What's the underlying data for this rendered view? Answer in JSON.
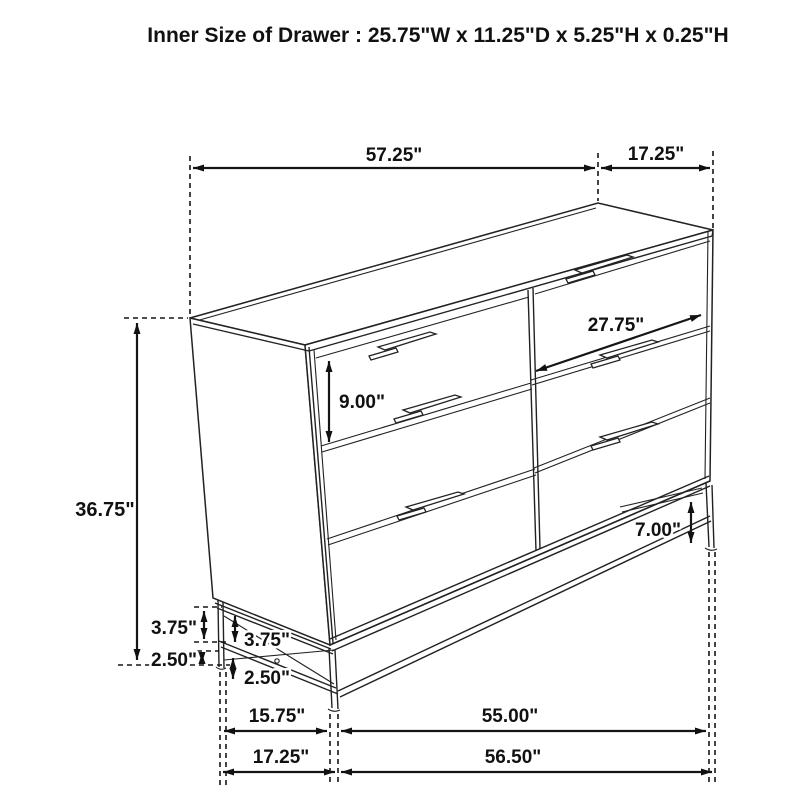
{
  "title": "Inner Size of Drawer : 25.75\"W x 11.25\"D x 5.25\"H x 0.25\"H",
  "colors": {
    "line": "#1f1f1f",
    "background": "#ffffff"
  },
  "dimensions": {
    "top_width": "57.25\"",
    "top_depth": "17.25\"",
    "drawer_width_diagonal": "27.75\"",
    "drawer_front_height": "9.00\"",
    "overall_height": "36.75\"",
    "base_gap_outer": "3.75\"",
    "base_gap_inner": "3.75\"",
    "base_lower_gap_outer": "2.50\"",
    "base_lower_gap_inner": "2.50\"",
    "base_leg_height": "7.00\"",
    "base_depth_inner": "15.75\"",
    "base_width_inner": "55.00\"",
    "base_depth_outer": "17.25\"",
    "base_width_outer": "56.50\""
  }
}
